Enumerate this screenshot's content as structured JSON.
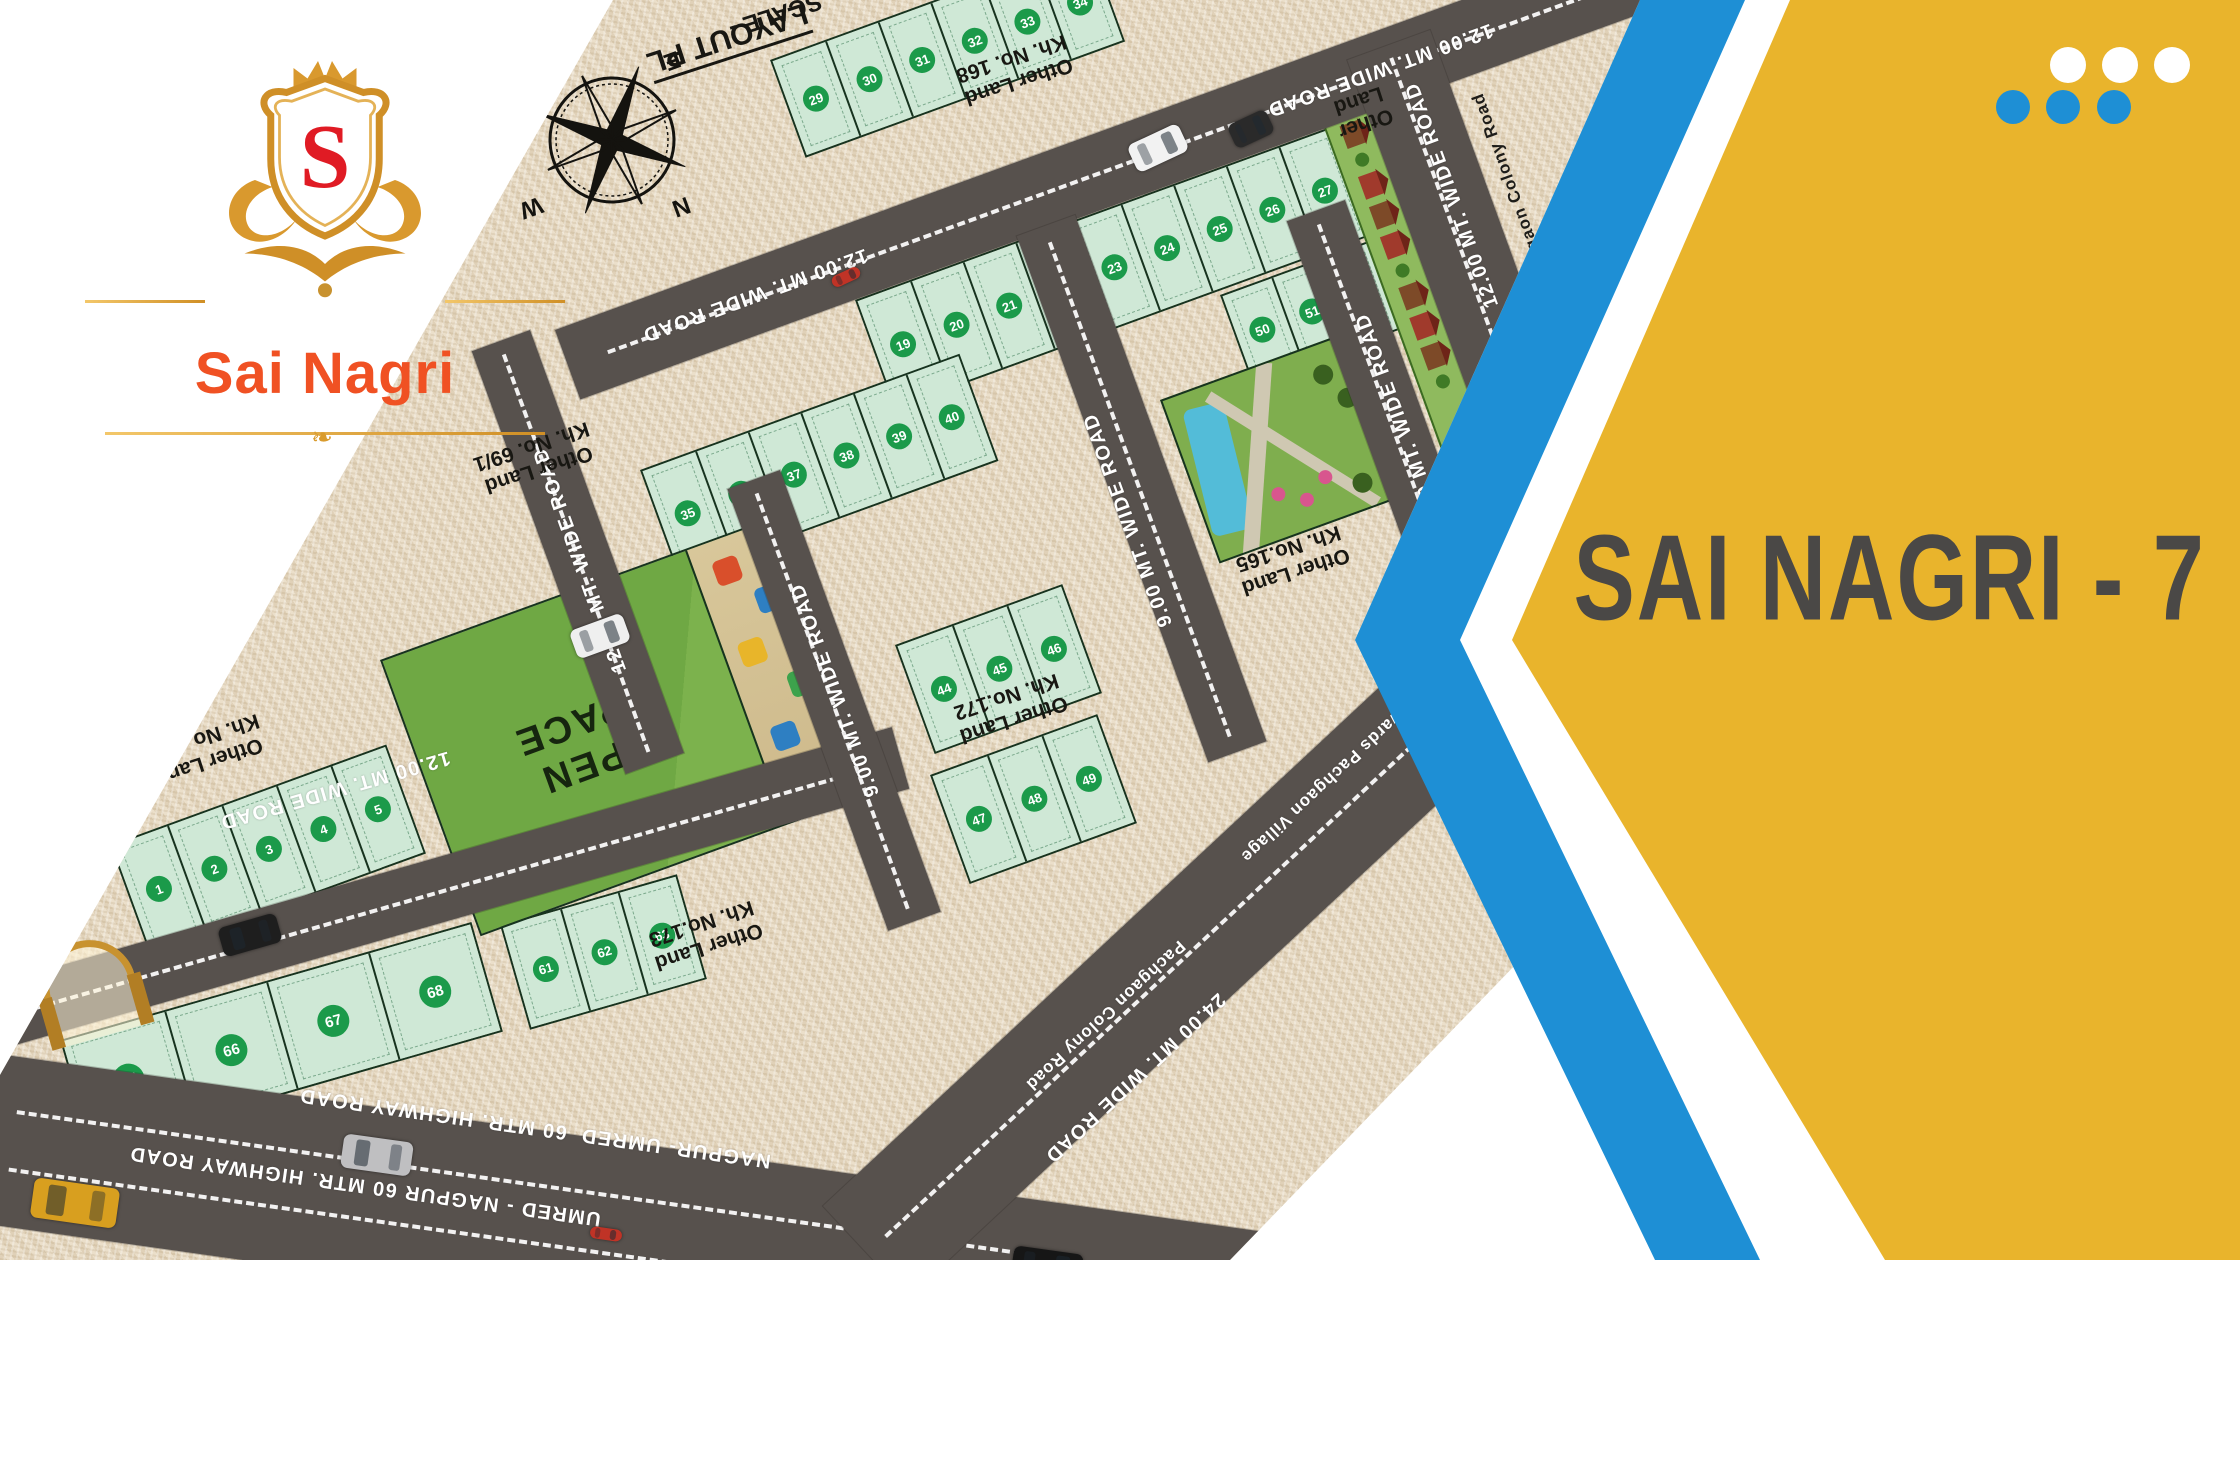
{
  "brand": {
    "monogram": "S",
    "name": "Sai Nagri"
  },
  "panel": {
    "title": "SAI NAGRI - 7",
    "yellow": "#e9b42c",
    "blue": "#1e8fd5",
    "title_color": "#4a4846"
  },
  "map": {
    "plan_title_line1": "LAYOUT PL",
    "plan_title_line2": "SCALE -",
    "open_space": "OPEN\nSPACE",
    "compass": {
      "n": "N",
      "s": "S",
      "e": "E",
      "w": "W"
    },
    "colors": {
      "plot": "#cfe8d6",
      "badge": "#1b9a4a",
      "road": "#57514d",
      "burlap": "#e8dbc3"
    },
    "roads": [
      {
        "x": 555,
        "y": 330,
        "w": 1400,
        "h": 74,
        "r": -20,
        "d": 1
      },
      {
        "x": -60,
        "y": 1000,
        "w": 990,
        "h": 64,
        "r": -16,
        "d": 1
      },
      {
        "x": -30,
        "y": 1050,
        "w": 1820,
        "h": 170,
        "r": 8,
        "d": 2
      },
      {
        "x": 530,
        "y": 330,
        "w": 450,
        "h": 62,
        "r": 70,
        "d": 1
      },
      {
        "x": 780,
        "y": 470,
        "w": 470,
        "h": 56,
        "r": 70,
        "d": 1
      },
      {
        "x": 1075,
        "y": 215,
        "w": 560,
        "h": 62,
        "r": 70,
        "d": 1
      },
      {
        "x": 1345,
        "y": 200,
        "w": 450,
        "h": 62,
        "r": 70,
        "d": 1
      },
      {
        "x": 1430,
        "y": 30,
        "w": 430,
        "h": 88,
        "r": 70,
        "d": 1
      },
      {
        "x": 823,
        "y": 1206,
        "w": 830,
        "h": 125,
        "r": -43,
        "d": 1
      }
    ],
    "road_labels": [
      {
        "t": "12.00 MT. WIDE ROAD",
        "x": 755,
        "y": 295,
        "r": 160
      },
      {
        "t": "12.00 MT. WIDE ROAD",
        "x": 1380,
        "y": 70,
        "r": 160
      },
      {
        "t": "12.00 MT. WIDE ROAD",
        "x": 335,
        "y": 790,
        "r": 164
      },
      {
        "t": "12.00 MT. WIDE ROAD",
        "x": 580,
        "y": 560,
        "r": -110
      },
      {
        "t": "9.00 MT. WIDE ROAD",
        "x": 835,
        "y": 690,
        "r": -110
      },
      {
        "t": "9.00 MT. WIDE ROAD",
        "x": 1128,
        "y": 520,
        "r": -110
      },
      {
        "t": "9.00 MT. WIDE ROAD",
        "x": 1400,
        "y": 420,
        "r": -110
      },
      {
        "t": "12.00 MT. WIDE ROAD",
        "x": 1452,
        "y": 195,
        "r": -110
      },
      {
        "t": "Shilgaon Colony Road",
        "x": 1512,
        "y": 188,
        "r": -110,
        "dark": true,
        "small": true
      },
      {
        "t": "Towards Pachgaon Village",
        "x": 1330,
        "y": 778,
        "r": 137,
        "small": true
      },
      {
        "t": "Pachgaon Colony Road",
        "x": 1105,
        "y": 1015,
        "r": 137,
        "small": true
      },
      {
        "t": "24.00 MT. WIDE ROAD",
        "x": 1135,
        "y": 1078,
        "r": 137
      },
      {
        "t": "NAGPUR- UMRED  60 MTR. HIGHWAY ROAD",
        "x": 535,
        "y": 1128,
        "r": 188
      },
      {
        "t": "UMRED - NAGPUR 60 MTR. HIGHWAY ROAD",
        "x": 365,
        "y": 1186,
        "r": 188
      }
    ],
    "area_labels": [
      {
        "l1": "Other Land",
        "l2": "Kh. No. 69/1",
        "x": 535,
        "y": 458,
        "r": 162
      },
      {
        "l1": "Other Land",
        "l2": "Kh. No. 69/2",
        "x": 205,
        "y": 750,
        "r": 162
      },
      {
        "l1": "Other Land",
        "l2": "Kh. No. 168",
        "x": 1015,
        "y": 70,
        "r": 162
      },
      {
        "l1": "Other Land",
        "l2": "Kh. No.165",
        "x": 1292,
        "y": 560,
        "r": 162
      },
      {
        "l1": "Other Land",
        "l2": "Kh. No.172",
        "x": 1010,
        "y": 708,
        "r": 162
      },
      {
        "l1": "Other Land",
        "l2": "Kh. No.173",
        "x": 705,
        "y": 935,
        "r": 162
      },
      {
        "l1": "Other",
        "l2": "Land",
        "x": 1362,
        "y": 112,
        "r": 162
      }
    ],
    "plot_rows": [
      {
        "x": 855,
        "y": 300,
        "r": -20,
        "w": 56,
        "h": 112,
        "nums": [
          19,
          20,
          21,
          22,
          23,
          24,
          25,
          26,
          27
        ]
      },
      {
        "x": 770,
        "y": 60,
        "r": -20,
        "w": 56,
        "h": 100,
        "nums": [
          29,
          30,
          31,
          32,
          33,
          34
        ]
      },
      {
        "x": 640,
        "y": 470,
        "r": -20,
        "w": 56,
        "h": 110,
        "nums": [
          35,
          36,
          37,
          38,
          39,
          40
        ]
      },
      {
        "x": 895,
        "y": 645,
        "r": -20,
        "w": 58,
        "h": 112,
        "nums": [
          44,
          45,
          46
        ]
      },
      {
        "x": 930,
        "y": 775,
        "r": -20,
        "w": 58,
        "h": 112,
        "nums": [
          47,
          48,
          49
        ]
      },
      {
        "x": 1220,
        "y": 295,
        "r": -20,
        "w": 52,
        "h": 90,
        "nums": [
          50,
          51,
          52
        ]
      },
      {
        "x": 110,
        "y": 845,
        "r": -20,
        "w": 58,
        "h": 112,
        "nums": [
          1,
          2,
          3,
          4,
          5
        ]
      },
      {
        "x": 500,
        "y": 925,
        "r": -16,
        "w": 60,
        "h": 105,
        "nums": [
          61,
          62,
          63
        ]
      },
      {
        "x": 60,
        "y": 1040,
        "r": -16,
        "w": 106,
        "h": 110,
        "big": true,
        "nums": [
          65,
          66,
          67,
          68
        ]
      }
    ],
    "vehicles": [
      {
        "t": "car",
        "c": "#f2f2f2",
        "x": 1143,
        "y": 120,
        "r": 65,
        "w": 30,
        "l": 56
      },
      {
        "t": "rickshaw",
        "c": "#2a2a2a",
        "x": 1238,
        "y": 108,
        "r": 65,
        "w": 26,
        "l": 42
      },
      {
        "t": "bike",
        "c": "#c03326",
        "x": 840,
        "y": 262,
        "r": 65,
        "w": 12,
        "l": 30
      },
      {
        "t": "car",
        "c": "#efefef",
        "x": 585,
        "y": 608,
        "r": 70,
        "w": 30,
        "l": 56
      },
      {
        "t": "car",
        "c": "#1e1e1e",
        "x": 235,
        "y": 905,
        "r": -106,
        "w": 30,
        "l": 60
      },
      {
        "t": "car",
        "c": "#bfbfc1",
        "x": 360,
        "y": 1120,
        "r": 278,
        "w": 34,
        "l": 70
      },
      {
        "t": "truck",
        "c": "#d89f1f",
        "x": 55,
        "y": 1160,
        "r": 278,
        "w": 40,
        "l": 86
      },
      {
        "t": "bike",
        "c": "#c03326",
        "x": 600,
        "y": 1218,
        "r": 98,
        "w": 12,
        "l": 32
      },
      {
        "t": "car",
        "c": "#161616",
        "x": 1030,
        "y": 1232,
        "r": 98,
        "w": 34,
        "l": 70
      }
    ]
  }
}
